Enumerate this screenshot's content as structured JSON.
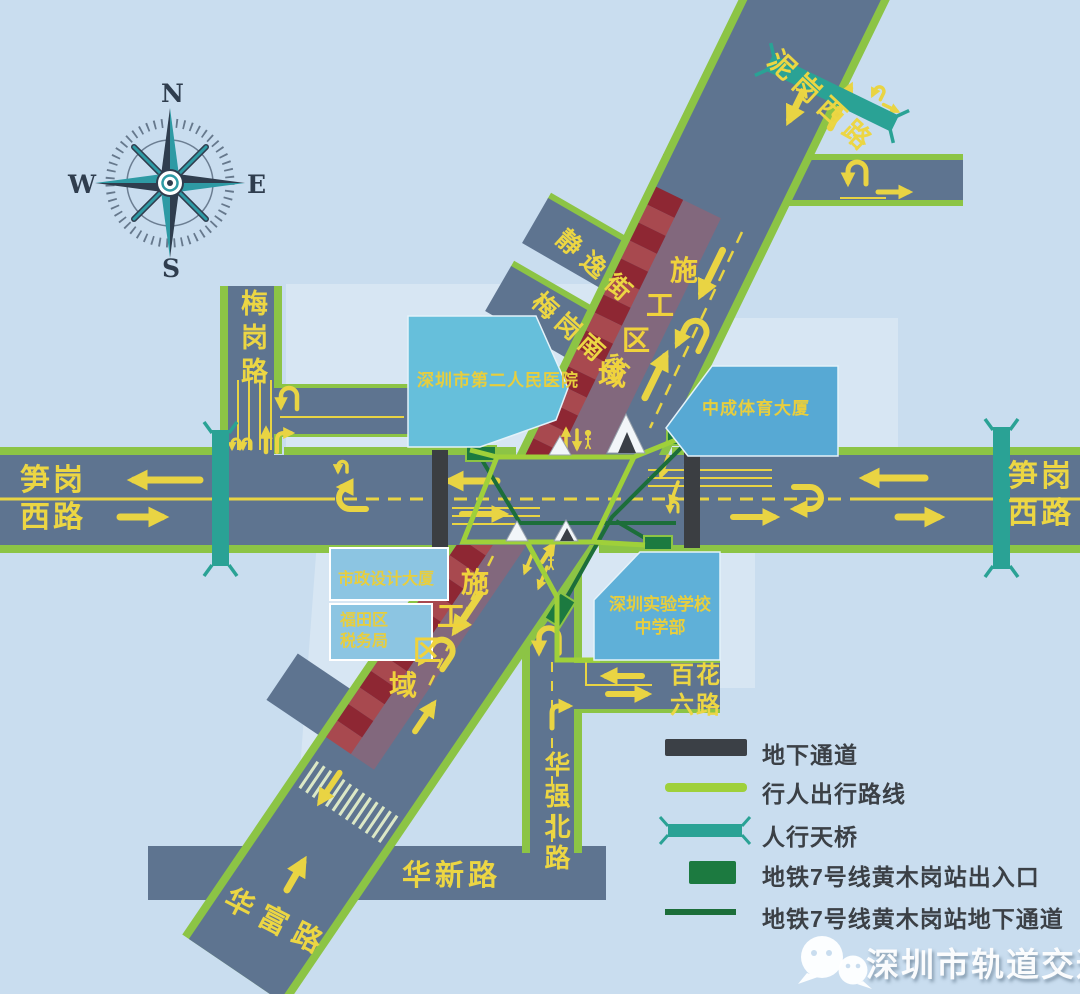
{
  "compass": {
    "n": "N",
    "e": "E",
    "s": "S",
    "w": "W"
  },
  "roads": {
    "nigang_west": "泥岗西路",
    "sungang_west_line1": "笋岗",
    "sungang_west_line2": "西路",
    "meigang": "梅岗路",
    "jingyi_street": "静逸街",
    "meigang_south_street": "梅岗南街",
    "huaqiang_north": "华强北路",
    "baihua_six_line1": "百花",
    "baihua_six_line2": "六路",
    "huaxin": "华新路",
    "huafu": "华富路"
  },
  "buildings": {
    "hospital": "深圳市第二人民医院",
    "zhongcheng_sports": "中成体育大厦",
    "municipal_design": "市政设计大厦",
    "futian_tax_line1": "福田区",
    "futian_tax_line2": "税务局",
    "school_line1": "深圳实验学校",
    "school_line2": "中学部"
  },
  "construction": {
    "chars": [
      "施",
      "工",
      "区",
      "域"
    ]
  },
  "legend": {
    "items": [
      {
        "label": "地下通道"
      },
      {
        "label": "行人出行路线"
      },
      {
        "label": "人行天桥"
      },
      {
        "label": "地铁7号线黄木岗站出入口"
      },
      {
        "label": "地铁7号线黄木岗站地下通道"
      }
    ]
  },
  "watermark": {
    "text": "深圳市轨道交通"
  },
  "colors": {
    "background": "#c9ddef",
    "road": "#5e7490",
    "road_edge": "#8cc445",
    "pedestrian_route": "#9fd03a",
    "construction_dark": "#8e2733",
    "construction_light": "#a8494f",
    "footbridge": "#2aa295",
    "metro_green": "#1c7a40",
    "underpass": "#3b3e42",
    "marking_yellow": "#e9d443",
    "building_blue": "#5fb0d8",
    "legend_text": "#3b4046"
  }
}
